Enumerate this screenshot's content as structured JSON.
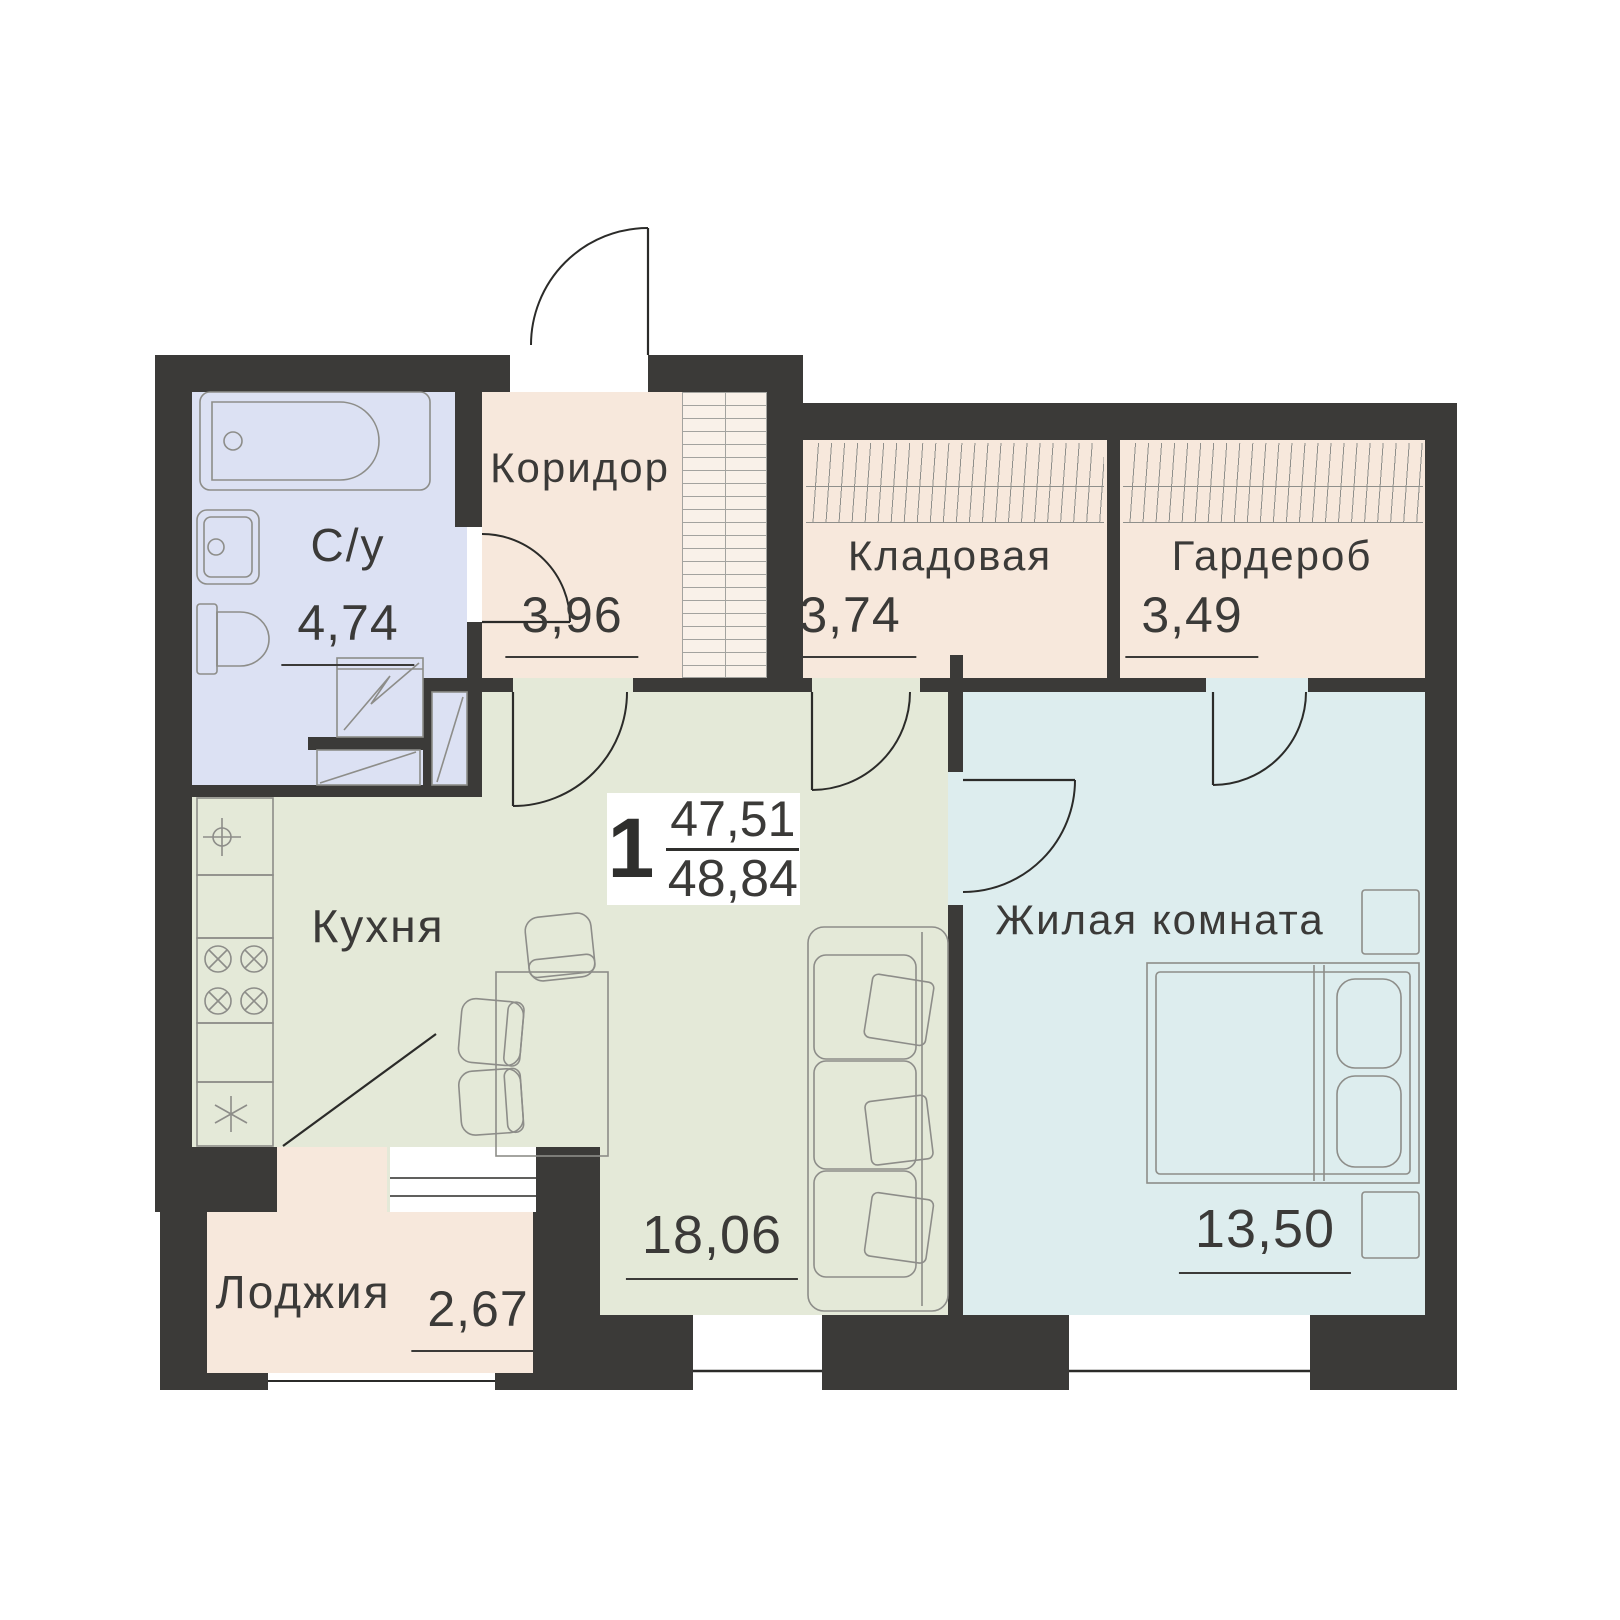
{
  "summary": {
    "rooms_count": "1",
    "area_upper": "47,51",
    "area_total": "48,84"
  },
  "rooms": {
    "bathroom": {
      "label": "С/у",
      "area": "4,74"
    },
    "corridor": {
      "label": "Коридор",
      "area": "3,96"
    },
    "storage": {
      "label": "Кладовая",
      "area": "3,74"
    },
    "wardrobe": {
      "label": "Гардероб",
      "area": "3,49"
    },
    "kitchen_living": {
      "label": "Кухня",
      "area": "18,06"
    },
    "living_room": {
      "label": "Жилая комната",
      "area": "13,50"
    },
    "loggia": {
      "label": "Лоджия",
      "area": "2,67"
    }
  },
  "colors": {
    "wall": "#3b3a38",
    "bathroom_floor": "#dce1f3",
    "hall_floor": "#f7e8dc",
    "kitchen_floor": "#e4e9d8",
    "bedroom_floor": "#ddedee",
    "furniture_line": "#8d8d89",
    "text": "#3b3a38"
  }
}
